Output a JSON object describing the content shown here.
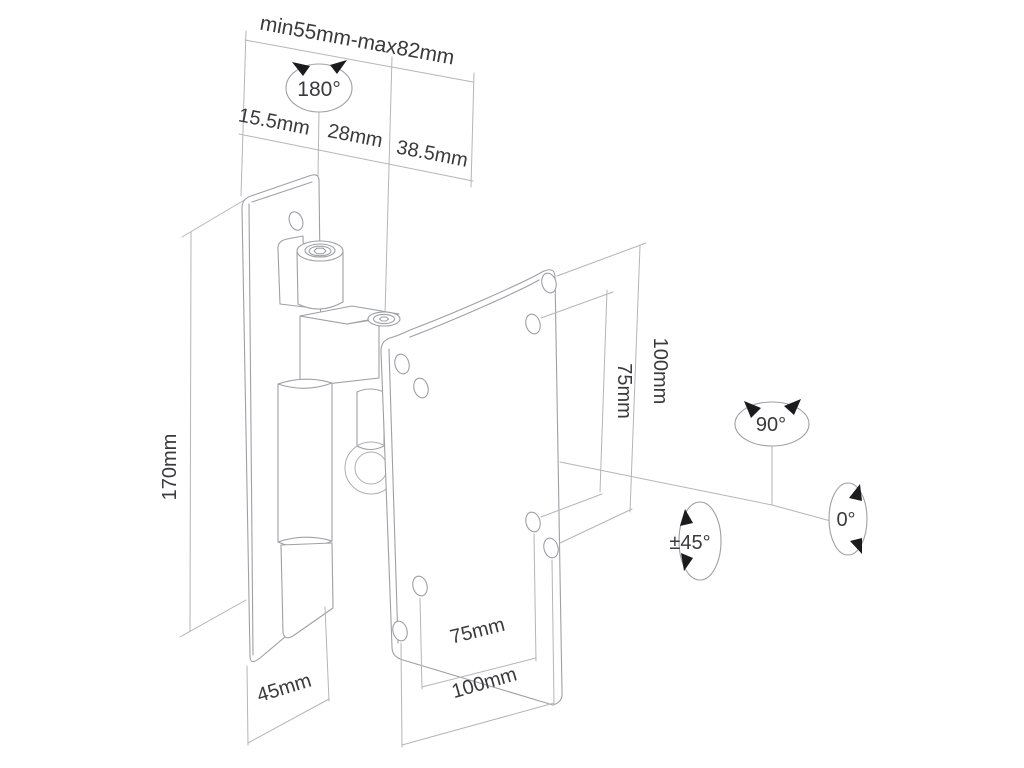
{
  "page": {
    "background_color": "#ffffff",
    "kind": "technical line drawing",
    "subject": "Tilt/swivel TV wall mount bracket with VESA plate — dimension and rotation diagram"
  },
  "colors": {
    "drawing_line": "#9fa0a5",
    "dimension_line": "#b5b5b9",
    "label_text": "#3a3a3d",
    "rotation_arrow": "#1b1b1d"
  },
  "labels": {
    "depth_range": "min55mm-max82mm",
    "swivel_rotation": "180°",
    "depth_seg1": "15.5mm",
    "depth_seg2": "28mm",
    "depth_seg3": "38.5mm",
    "bracket_height": "170mm",
    "vesa_vertical_100": "100mm",
    "vesa_vertical_75": "75mm",
    "tilt_rotation": "90°",
    "rotation_zero": "0°",
    "side_rotation": "±45°",
    "wall_plate_width": "45mm",
    "vesa_horizontal_75": "75mm",
    "vesa_horizontal_100": "100mm"
  }
}
